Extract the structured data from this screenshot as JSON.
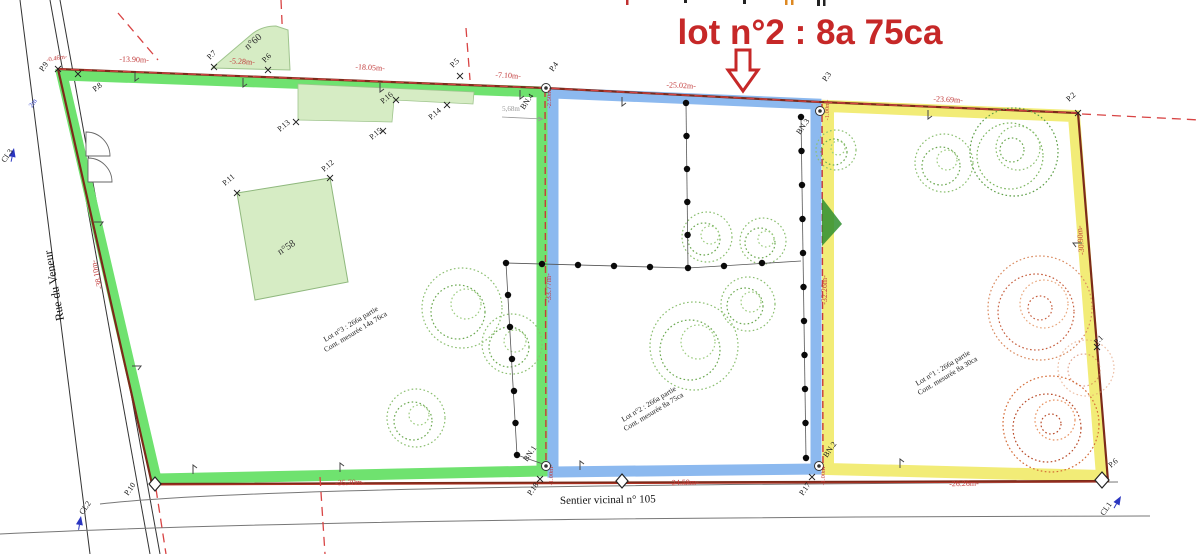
{
  "title": {
    "text": "lot n°2 : 8a 75ca"
  },
  "streets": {
    "left": "Rue du Veneur",
    "bottom": "Sentier vicinal n° 105"
  },
  "buildings": {
    "left": "n°58",
    "top": "n°60"
  },
  "lot_labels": [
    {
      "line1": "Lot n°3 : 266a partie",
      "line2": "Cont. mesurée 14a 76ca"
    },
    {
      "line1": "Lot n°2 : 266a partie",
      "line2": "Cont. mesurée 8a 75ca"
    },
    {
      "line1": "Lot n°1 : 266a partie",
      "line2": "Cont. mesurée 8a 30ca"
    }
  ],
  "measurements": [
    "-13.90m-",
    "-5.28m-",
    "-18.05m-",
    "-7.10m-",
    "-25.02m-",
    "-23.69m-",
    "-38.10m-",
    "-30.90m-",
    "-33.77m-",
    "-32.26m-",
    "-35.70m-",
    "-24.58m-",
    "-26.26m-",
    "-0.46m-",
    "-1.00m-",
    "-1.00m-",
    "-2.50m-",
    "-1.00m-",
    "5,68m"
  ],
  "points": [
    "P.9",
    "P.8",
    "P.7",
    "P.6",
    "P.5",
    "P.4",
    "P.3",
    "P.2",
    "P.1",
    "P.6",
    "P.10",
    "P.18",
    "P.17",
    "P.11",
    "P.12",
    "P.13",
    "P.14",
    "P.15",
    "P.16",
    "BN.4",
    "BN.3",
    "BN.1",
    "BN.2",
    "CL3",
    "CL2",
    "CL1"
  ],
  "misc": {
    "small_blue": "2m"
  },
  "colors": {
    "title_red": "#c62828",
    "lot3_green": "#6fe26f",
    "lot2_blue": "#8cb9ef",
    "lot1_yellow": "#f2ec77",
    "boundary_brown": "#7c2a1a",
    "dash_red": "#d84444",
    "measure_red": "#c23b3b"
  }
}
